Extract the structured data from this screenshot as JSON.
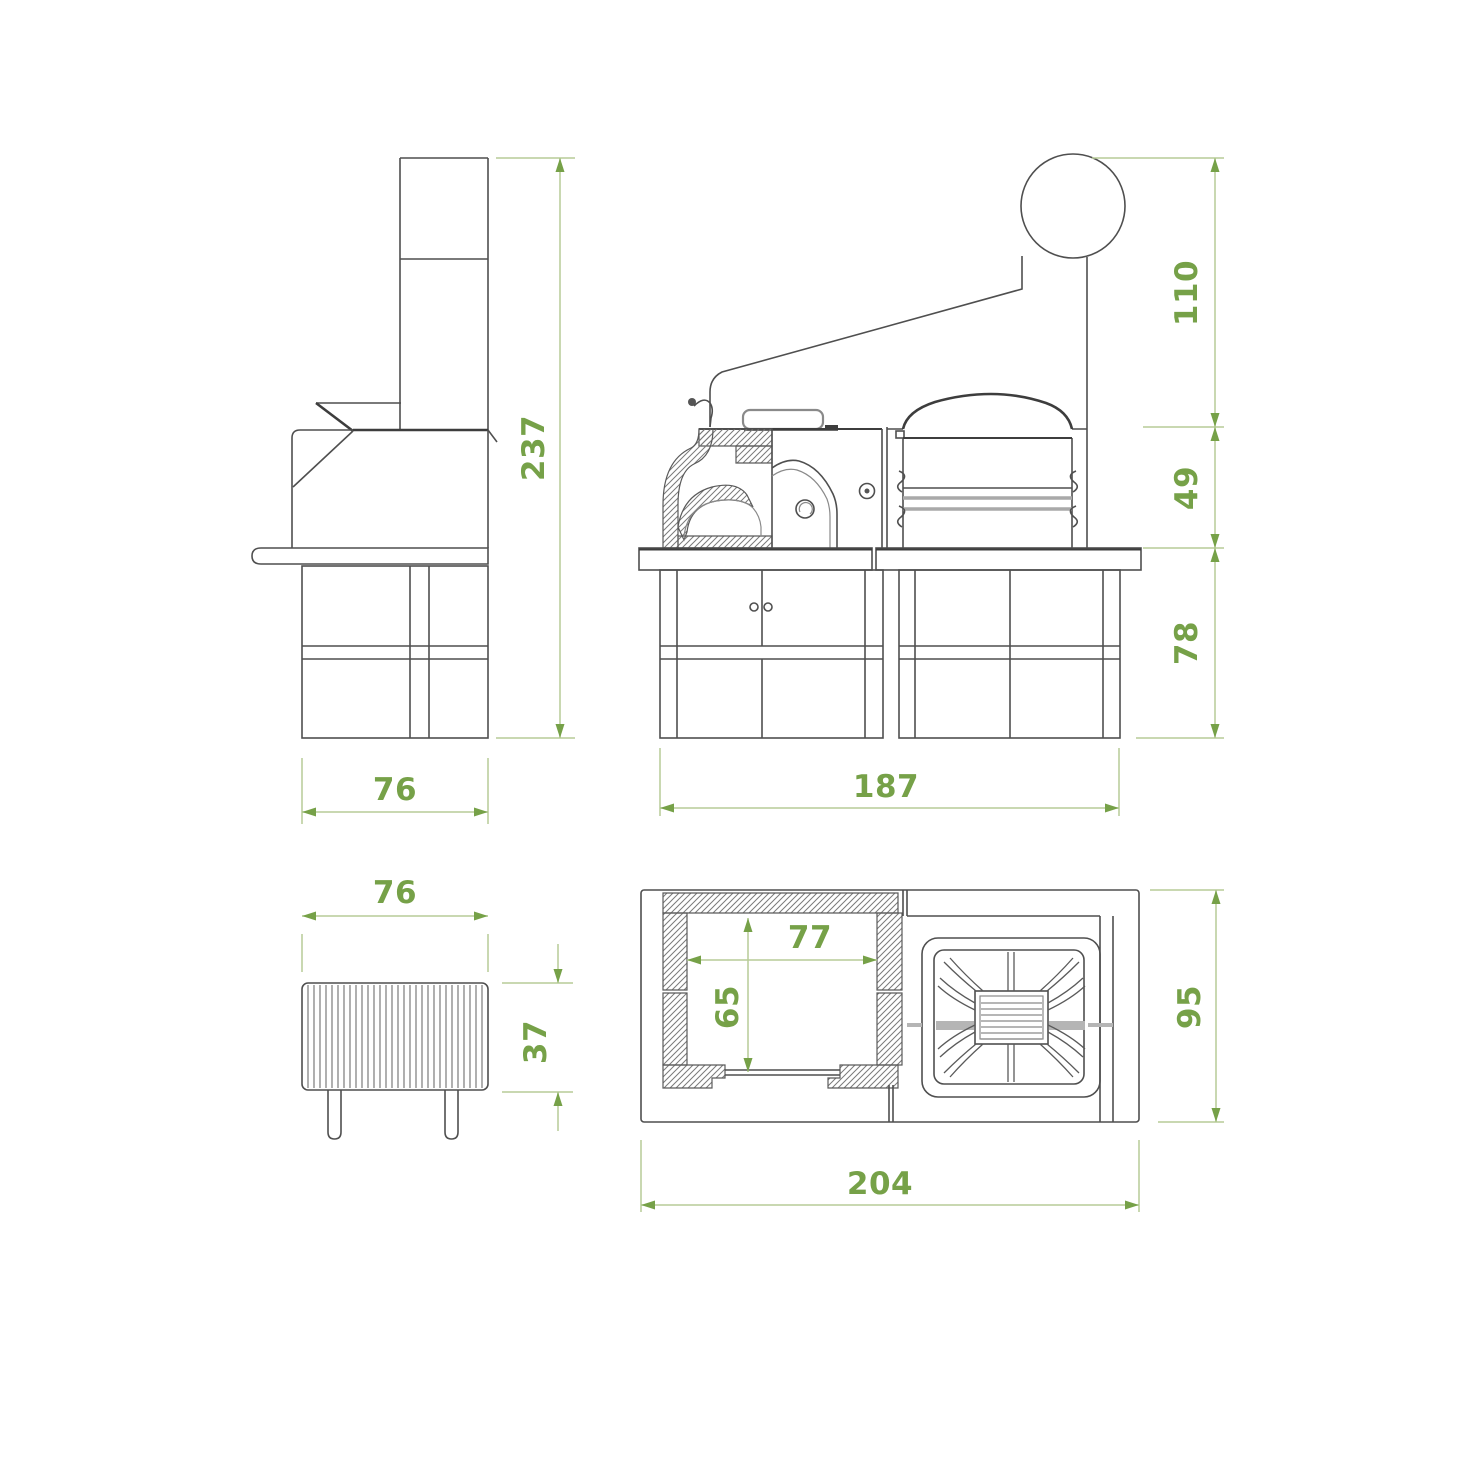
{
  "drawing": {
    "type": "technical-drawing-barbecue-oven",
    "views": {
      "side": {
        "dims": {
          "height": "237",
          "width": "76"
        }
      },
      "front": {
        "dims": {
          "hood_height": "110",
          "firebox_height": "49",
          "base_height": "78",
          "width": "187"
        }
      },
      "grate": {
        "dims": {
          "width": "76",
          "height": "37"
        }
      },
      "plan": {
        "dims": {
          "oven_inner_width": "77",
          "oven_inner_depth": "65",
          "depth": "95",
          "width": "204"
        }
      }
    },
    "colors": {
      "outline": "#4f4f4f",
      "outline_heavy": "#3d3d3d",
      "dimension_text": "#76a148",
      "dimension_line": "#b7cc97",
      "hatch": "#7a7a7a",
      "gray_detail": "#a9a9a9"
    }
  }
}
